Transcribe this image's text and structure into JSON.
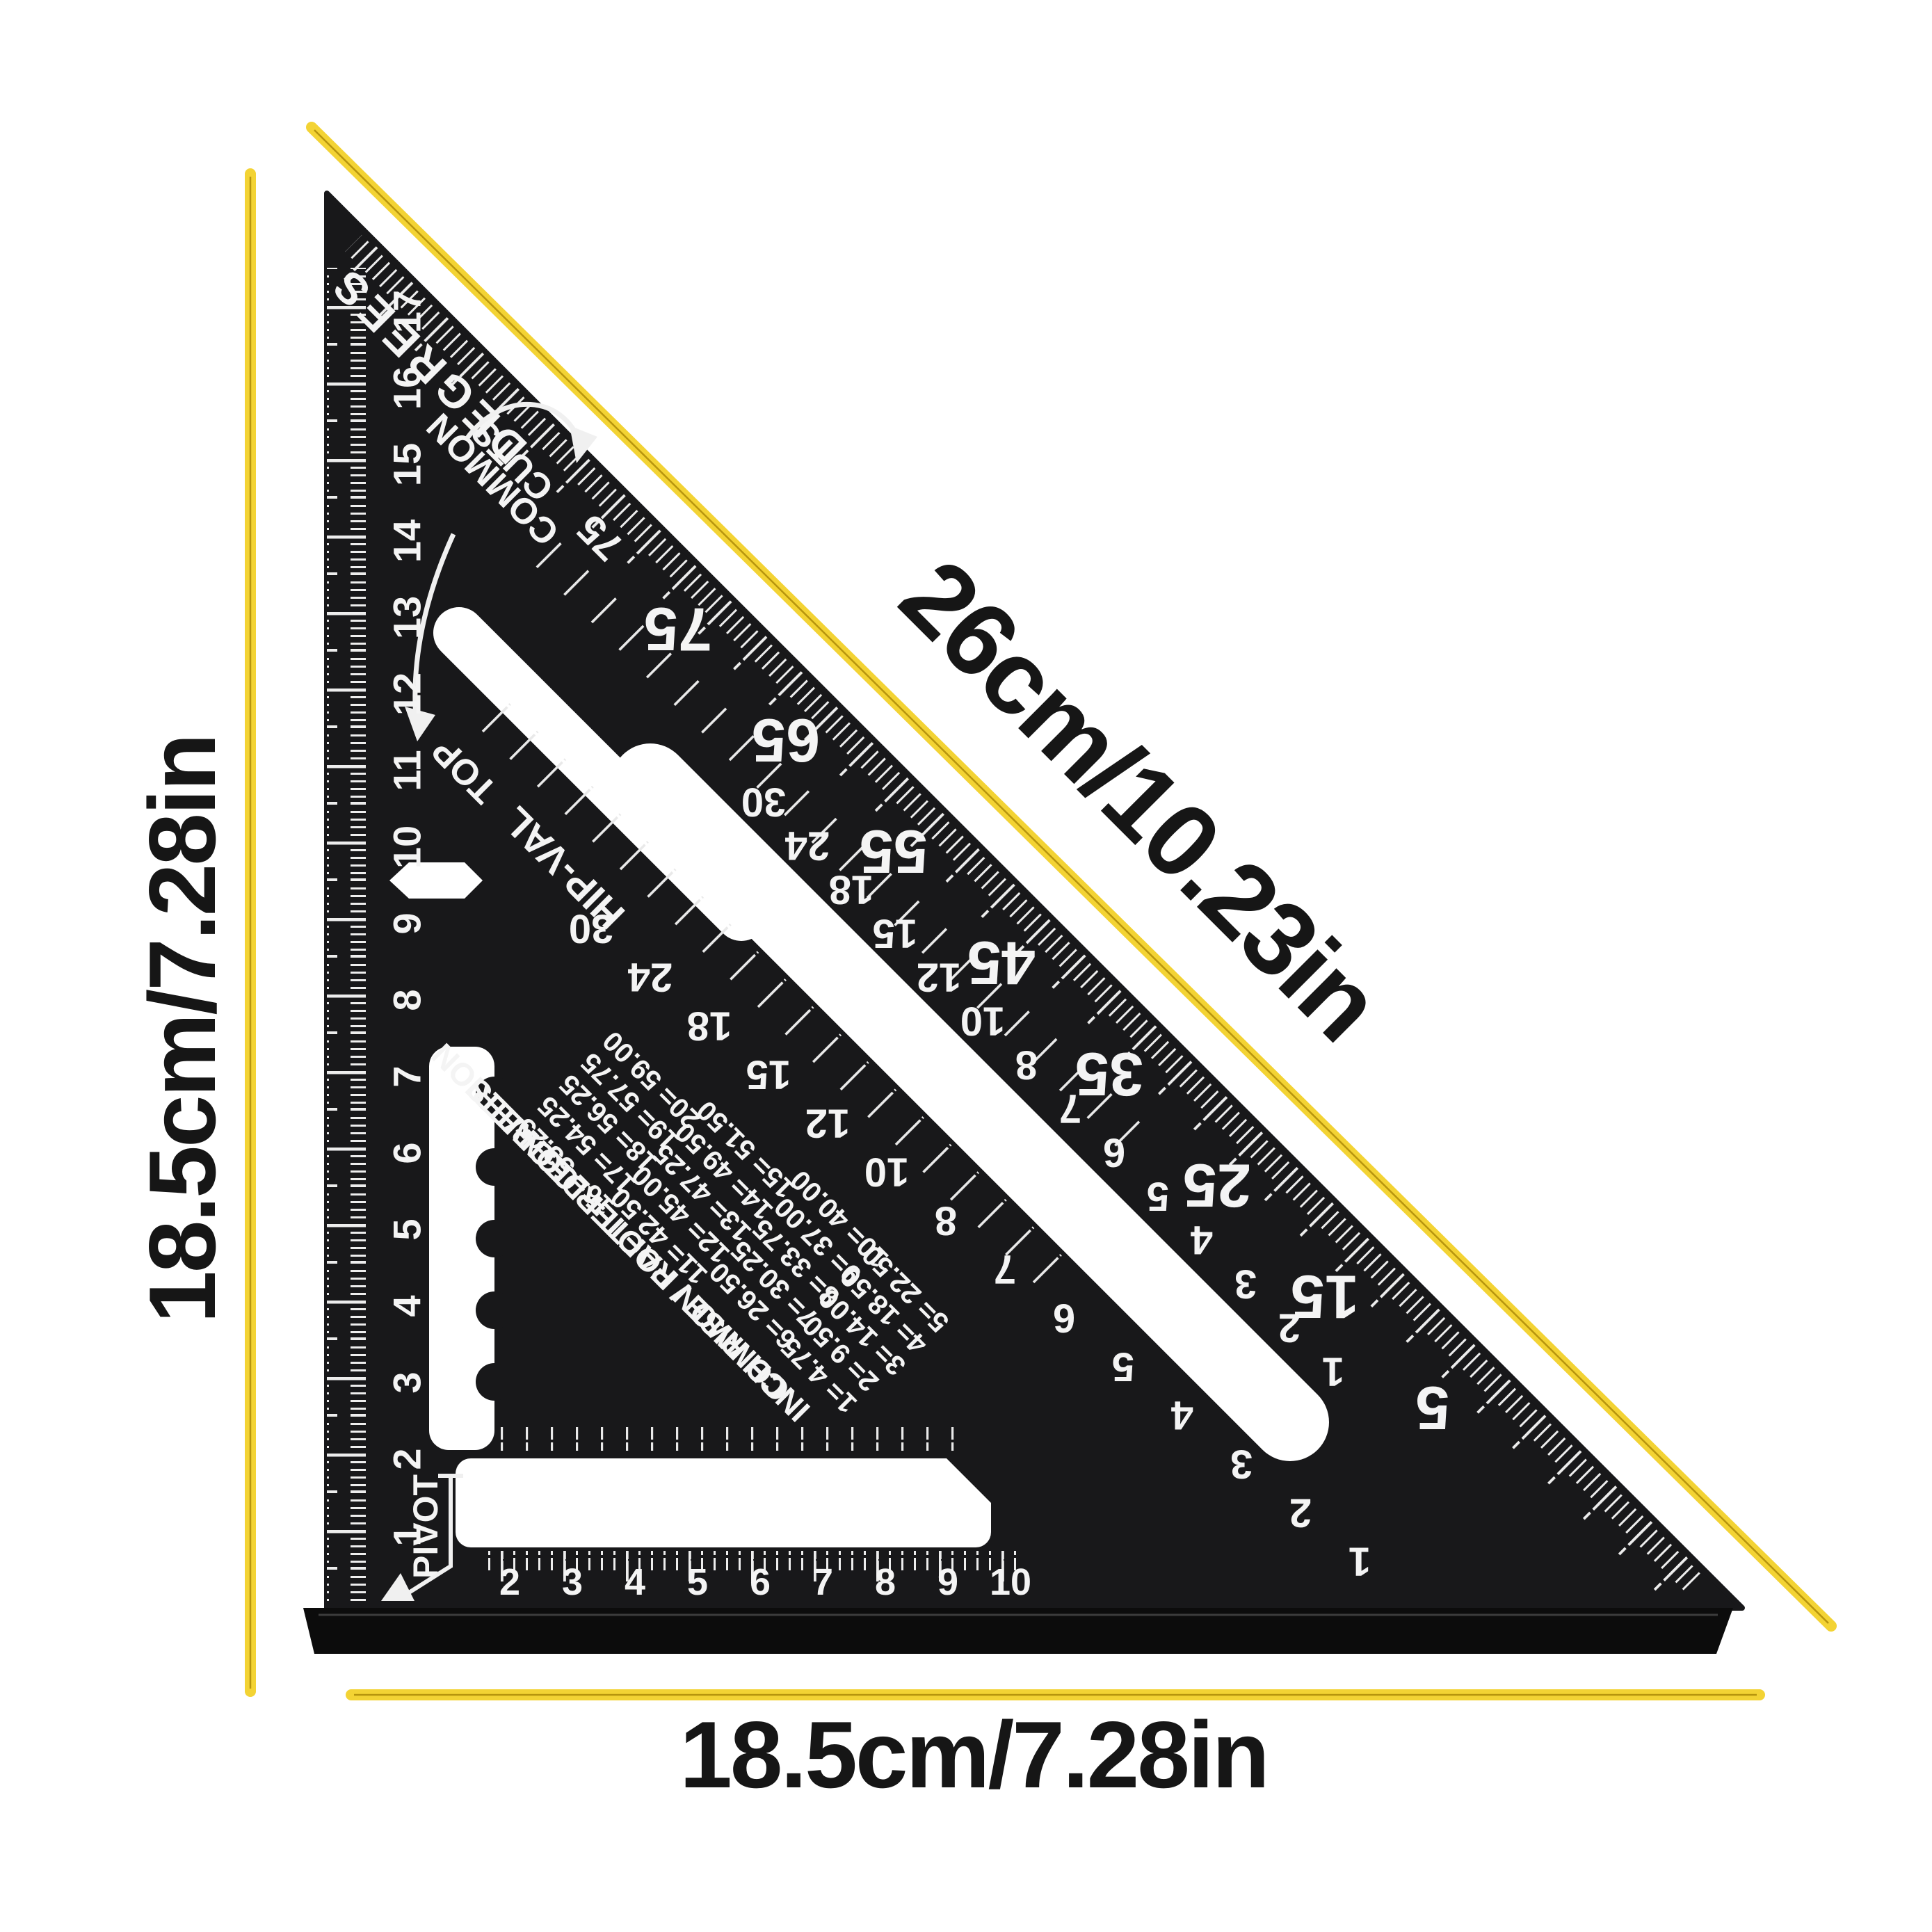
{
  "product": {
    "dimension_hypotenuse": "26cm/10.23in",
    "dimension_left": "18.5cm/7.28in",
    "dimension_bottom": "18.5cm/7.28in"
  },
  "square": {
    "degrees_label": "DEGREES",
    "cuts_label": "CUTS",
    "common_label": "COMMON",
    "common_cuts_angle": "75",
    "top_label": "TOP",
    "hip_val_label": "HIP-VAL",
    "pivot_label": "PIVOT",
    "degree_scale": [
      "75",
      "65",
      "55",
      "45",
      "35",
      "25",
      "15",
      "5"
    ],
    "common_scale": [
      "30",
      "24",
      "18",
      "15",
      "12",
      "10",
      "8",
      "7",
      "6",
      "5",
      "4",
      "3",
      "2",
      "1"
    ],
    "hip_val_scale": [
      "30",
      "24",
      "18",
      "15",
      "12",
      "10",
      "8",
      "7",
      "6",
      "5",
      "4",
      "3",
      "2",
      "1"
    ],
    "cm_scale": [
      "1",
      "2",
      "3",
      "4",
      "5",
      "6",
      "7",
      "8",
      "9",
      "10",
      "11",
      "12",
      "13",
      "14",
      "15",
      "16",
      "17"
    ],
    "bottom_scale": [
      "2",
      "3",
      "4",
      "5",
      "6",
      "7",
      "8",
      "9",
      "10"
    ],
    "rafter_table": {
      "title_line1": "COMMON RAFTER CONVERION",
      "title_line2": "INCH RISE / FOOT = DEGREES",
      "block1": [
        "16= 53.25",
        "17= 54.25",
        "18= 56.25",
        "19= 57.75",
        "20= 59.00"
      ],
      "block2": [
        "11= 42.50",
        "12= 45.00",
        "13= 47.25",
        "14= 49.50",
        "15= 51.50"
      ],
      "block3": [
        "6= 26.50",
        "7= 30.25",
        "8= 33.75",
        "9= 37.00",
        "10= 40.00"
      ],
      "block4": [
        "1= 4.75",
        "2= 9.50",
        "3= 14.00",
        "4= 18.50",
        "5= 22.50"
      ]
    }
  },
  "colors": {
    "accent_yellow": "#F3D334",
    "accent_yellow_core": "#B7950E",
    "square_black": "#18181a",
    "flange_black": "#0c0c0c",
    "marking_white": "#F4F4F4"
  }
}
